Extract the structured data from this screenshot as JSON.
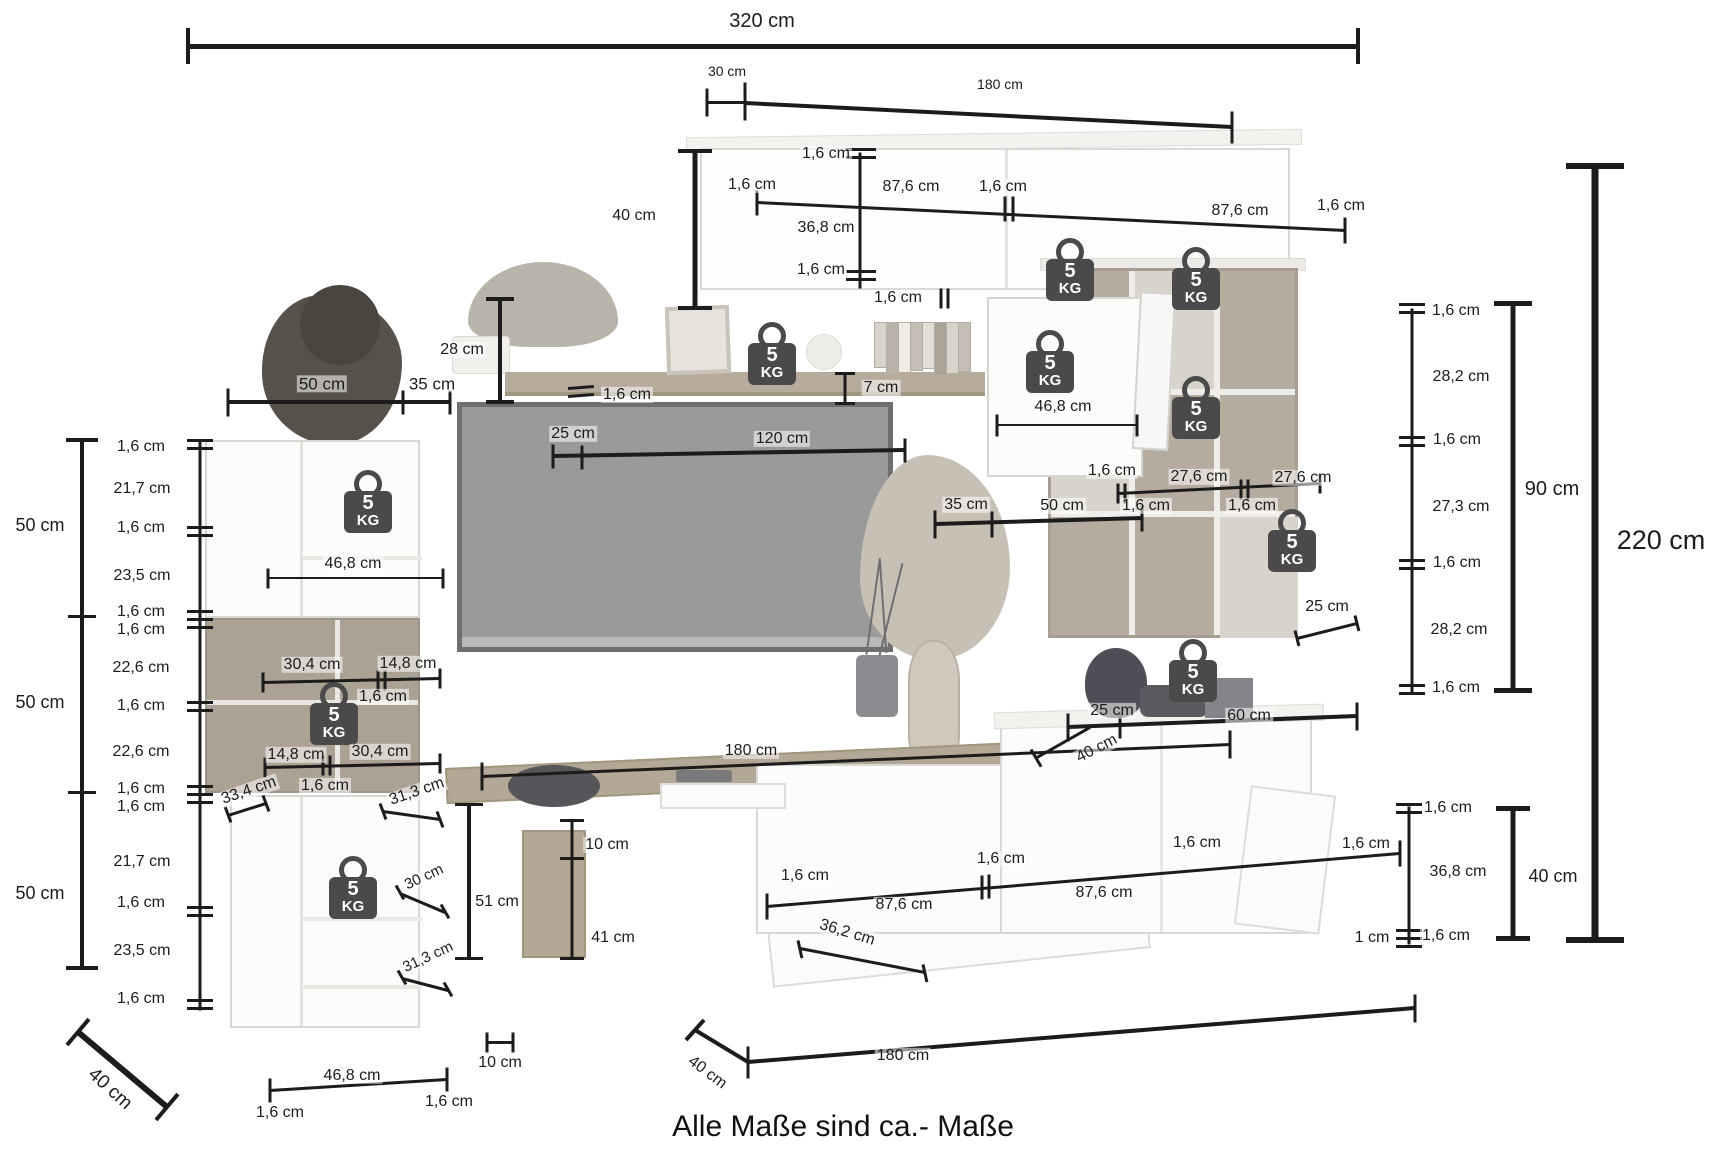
{
  "caption": "Alle Maße sind ca.- Maße",
  "unit": "cm",
  "weight_badge": {
    "value": "5",
    "unit": "KG"
  },
  "colors": {
    "line": "#1c1c1c",
    "label": "#1c1c1c",
    "badge": "#4a4a4a",
    "badge_text": "#ffffff",
    "wood": "#b3a795",
    "wood_dark": "#aca293",
    "white_furniture": "#fcfcfb",
    "tv_screen": "#9a9a9a"
  },
  "labels": [
    {
      "t": "320 cm",
      "x": 762,
      "y": 21,
      "fs": 20
    },
    {
      "t": "30 cm",
      "x": 727,
      "y": 71,
      "fs": 14
    },
    {
      "t": "180 cm",
      "x": 1000,
      "y": 84,
      "fs": 14
    },
    {
      "t": "40 cm",
      "x": 634,
      "y": 216
    },
    {
      "t": "1,6 cm",
      "x": 826,
      "y": 154
    },
    {
      "t": "1,6 cm",
      "x": 752,
      "y": 185
    },
    {
      "t": "87,6 cm",
      "x": 911,
      "y": 187
    },
    {
      "t": "1,6 cm",
      "x": 1003,
      "y": 187
    },
    {
      "t": "87,6 cm",
      "x": 1240,
      "y": 211
    },
    {
      "t": "1,6 cm",
      "x": 1341,
      "y": 206
    },
    {
      "t": "36,8 cm",
      "x": 826,
      "y": 228
    },
    {
      "t": "1,6 cm",
      "x": 821,
      "y": 270
    },
    {
      "t": "28 cm",
      "x": 462,
      "y": 350
    },
    {
      "t": "1,6 cm",
      "x": 627,
      "y": 395
    },
    {
      "t": "7 cm",
      "x": 881,
      "y": 388
    },
    {
      "t": "1,6 cm",
      "x": 898,
      "y": 298
    },
    {
      "t": "46,8 cm",
      "x": 1063,
      "y": 407
    },
    {
      "t": "25 cm",
      "x": 573,
      "y": 434
    },
    {
      "t": "120 cm",
      "x": 782,
      "y": 439
    },
    {
      "t": "1,6 cm",
      "x": 1112,
      "y": 471
    },
    {
      "t": "27,6 cm",
      "x": 1199,
      "y": 477
    },
    {
      "t": "27,6 cm",
      "x": 1303,
      "y": 478
    },
    {
      "t": "1,6 cm",
      "x": 1146,
      "y": 506
    },
    {
      "t": "1,6 cm",
      "x": 1252,
      "y": 506
    },
    {
      "t": "35 cm",
      "x": 966,
      "y": 505
    },
    {
      "t": "50 cm",
      "x": 1062,
      "y": 506
    },
    {
      "t": "1,6 cm",
      "x": 1456,
      "y": 311
    },
    {
      "t": "28,2 cm",
      "x": 1461,
      "y": 377
    },
    {
      "t": "1,6 cm",
      "x": 1457,
      "y": 440
    },
    {
      "t": "27,3 cm",
      "x": 1461,
      "y": 507
    },
    {
      "t": "1,6 cm",
      "x": 1457,
      "y": 563
    },
    {
      "t": "28,2 cm",
      "x": 1459,
      "y": 630
    },
    {
      "t": "1,6 cm",
      "x": 1456,
      "y": 688
    },
    {
      "t": "90 cm",
      "x": 1552,
      "y": 489,
      "fs": 20
    },
    {
      "t": "220 cm",
      "x": 1661,
      "y": 541,
      "fs": 27
    },
    {
      "t": "25 cm",
      "x": 1327,
      "y": 607
    },
    {
      "t": "25 cm",
      "x": 1112,
      "y": 711
    },
    {
      "t": "60 cm",
      "x": 1249,
      "y": 716
    },
    {
      "t": "40 cm",
      "x": 1097,
      "y": 749,
      "rot": -27
    },
    {
      "t": "180 cm",
      "x": 751,
      "y": 751
    },
    {
      "t": "10 cm",
      "x": 607,
      "y": 845
    },
    {
      "t": "51 cm",
      "x": 497,
      "y": 902
    },
    {
      "t": "41 cm",
      "x": 613,
      "y": 938
    },
    {
      "t": "1,6 cm",
      "x": 805,
      "y": 876
    },
    {
      "t": "87,6 cm",
      "x": 904,
      "y": 905
    },
    {
      "t": "1,6 cm",
      "x": 1001,
      "y": 859
    },
    {
      "t": "87,6 cm",
      "x": 1104,
      "y": 893
    },
    {
      "t": "1,6 cm",
      "x": 1197,
      "y": 843
    },
    {
      "t": "36,2 cm",
      "x": 847,
      "y": 933,
      "rot": 17
    },
    {
      "t": "1 cm",
      "x": 1372,
      "y": 938
    },
    {
      "t": "1,6 cm",
      "x": 1446,
      "y": 936
    },
    {
      "t": "1,6 cm",
      "x": 1448,
      "y": 808
    },
    {
      "t": "1,6 cm",
      "x": 1366,
      "y": 844
    },
    {
      "t": "36,8 cm",
      "x": 1458,
      "y": 872
    },
    {
      "t": "40 cm",
      "x": 1553,
      "y": 876,
      "fs": 18
    },
    {
      "t": "50  cm",
      "x": 322,
      "y": 384,
      "fs": 17
    },
    {
      "t": "35  cm",
      "x": 432,
      "y": 384,
      "fs": 17
    },
    {
      "t": "1,6 cm",
      "x": 141,
      "y": 447
    },
    {
      "t": "21,7 cm",
      "x": 142,
      "y": 489
    },
    {
      "t": "50 cm",
      "x": 40,
      "y": 525,
      "fs": 18
    },
    {
      "t": "1,6 cm",
      "x": 141,
      "y": 528
    },
    {
      "t": "23,5 cm",
      "x": 142,
      "y": 576
    },
    {
      "t": "1,6 cm",
      "x": 141,
      "y": 612
    },
    {
      "t": "1,6 cm",
      "x": 141,
      "y": 630
    },
    {
      "t": "22,6 cm",
      "x": 141,
      "y": 668
    },
    {
      "t": "50 cm",
      "x": 40,
      "y": 702,
      "fs": 18
    },
    {
      "t": "1,6 cm",
      "x": 141,
      "y": 706
    },
    {
      "t": "22,6 cm",
      "x": 141,
      "y": 752
    },
    {
      "t": "1,6 cm",
      "x": 141,
      "y": 789
    },
    {
      "t": "1,6 cm",
      "x": 141,
      "y": 807
    },
    {
      "t": "21,7 cm",
      "x": 142,
      "y": 862
    },
    {
      "t": "50 cm",
      "x": 40,
      "y": 893,
      "fs": 18
    },
    {
      "t": "1,6 cm",
      "x": 141,
      "y": 903
    },
    {
      "t": "23,5 cm",
      "x": 142,
      "y": 951
    },
    {
      "t": "1,6 cm",
      "x": 141,
      "y": 999
    },
    {
      "t": "46,8 cm",
      "x": 353,
      "y": 564
    },
    {
      "t": "30,4 cm",
      "x": 312,
      "y": 665
    },
    {
      "t": "14,8 cm",
      "x": 408,
      "y": 664
    },
    {
      "t": "1,6 cm",
      "x": 383,
      "y": 697
    },
    {
      "t": "14,8 cm",
      "x": 296,
      "y": 755
    },
    {
      "t": "30,4 cm",
      "x": 380,
      "y": 752
    },
    {
      "t": "1,6 cm",
      "x": 325,
      "y": 786
    },
    {
      "t": "33,4 cm",
      "x": 249,
      "y": 791,
      "rot": -19
    },
    {
      "t": "31,3 cm",
      "x": 417,
      "y": 792,
      "rot": -19
    },
    {
      "t": "30 cm",
      "x": 424,
      "y": 877,
      "fs": 15,
      "rot": -25
    },
    {
      "t": "31,3 cm",
      "x": 428,
      "y": 957,
      "fs": 15,
      "rot": -25
    },
    {
      "t": "46,8 cm",
      "x": 352,
      "y": 1076
    },
    {
      "t": "1,6 cm",
      "x": 280,
      "y": 1113
    },
    {
      "t": "1,6 cm",
      "x": 449,
      "y": 1102
    },
    {
      "t": "40 cm",
      "x": 110,
      "y": 1089,
      "fs": 19,
      "rot": 42
    },
    {
      "t": "10 cm",
      "x": 500,
      "y": 1063
    },
    {
      "t": "40 cm",
      "x": 707,
      "y": 1073,
      "rot": 37
    },
    {
      "t": "180 cm",
      "x": 903,
      "y": 1056
    }
  ],
  "weights": [
    {
      "x": 1070,
      "y": 268
    },
    {
      "x": 772,
      "y": 352
    },
    {
      "x": 1050,
      "y": 360
    },
    {
      "x": 1196,
      "y": 277
    },
    {
      "x": 1196,
      "y": 406
    },
    {
      "x": 1292,
      "y": 539
    },
    {
      "x": 1193,
      "y": 669
    },
    {
      "x": 368,
      "y": 500
    },
    {
      "x": 334,
      "y": 712
    },
    {
      "x": 353,
      "y": 886
    }
  ],
  "lines": [
    [
      190,
      46,
      1360,
      46,
      5
    ],
    [
      188,
      28,
      188,
      64,
      4
    ],
    [
      1358,
      28,
      1358,
      64,
      4
    ],
    [
      707,
      88,
      707,
      116,
      3
    ],
    [
      745,
      82,
      745,
      120,
      3
    ],
    [
      707,
      102,
      745,
      102,
      3
    ],
    [
      745,
      103,
      1232,
      127,
      4
    ],
    [
      1232,
      111,
      1232,
      143,
      3
    ],
    [
      695,
      152,
      695,
      308,
      5
    ],
    [
      678,
      151,
      712,
      151,
      4
    ],
    [
      678,
      308,
      712,
      308,
      4
    ],
    [
      860,
      152,
      860,
      288,
      3
    ],
    [
      846,
      149,
      876,
      149,
      3
    ],
    [
      846,
      157,
      876,
      157,
      3
    ],
    [
      846,
      271,
      876,
      271,
      3
    ],
    [
      846,
      279,
      876,
      279,
      3
    ],
    [
      757,
      202,
      1345,
      230,
      3
    ],
    [
      757,
      190,
      757,
      215,
      3
    ],
    [
      1005,
      196,
      1005,
      221,
      3
    ],
    [
      1013,
      196,
      1013,
      221,
      3
    ],
    [
      1345,
      217,
      1345,
      243,
      3
    ],
    [
      500,
      300,
      500,
      402,
      4
    ],
    [
      486,
      299,
      514,
      299,
      4
    ],
    [
      486,
      402,
      514,
      402,
      4
    ],
    [
      568,
      388,
      594,
      386,
      3
    ],
    [
      568,
      396,
      594,
      394,
      3
    ],
    [
      845,
      374,
      845,
      403,
      3
    ],
    [
      835,
      373,
      855,
      373,
      3
    ],
    [
      835,
      403,
      855,
      403,
      3
    ],
    [
      941,
      288,
      941,
      308,
      3
    ],
    [
      948,
      288,
      948,
      308,
      3
    ],
    [
      997,
      425,
      1137,
      425,
      2
    ],
    [
      997,
      414,
      997,
      436,
      3
    ],
    [
      1137,
      414,
      1137,
      436,
      3
    ],
    [
      553,
      456,
      905,
      450,
      4
    ],
    [
      553,
      444,
      553,
      468,
      3
    ],
    [
      582,
      445,
      582,
      469,
      3
    ],
    [
      905,
      438,
      905,
      462,
      3
    ],
    [
      1118,
      493,
      1320,
      483,
      3
    ],
    [
      1118,
      483,
      1118,
      503,
      3
    ],
    [
      1125,
      483,
      1125,
      503,
      3
    ],
    [
      1241,
      479,
      1241,
      499,
      3
    ],
    [
      1248,
      479,
      1248,
      499,
      3
    ],
    [
      1320,
      473,
      1320,
      493,
      3
    ],
    [
      935,
      524,
      1142,
      518,
      4
    ],
    [
      935,
      510,
      935,
      538,
      3
    ],
    [
      992,
      511,
      992,
      537,
      3
    ],
    [
      1142,
      505,
      1142,
      531,
      3
    ],
    [
      1297,
      638,
      1357,
      623,
      3
    ],
    [
      1295,
      630,
      1299,
      646,
      3
    ],
    [
      1355,
      615,
      1359,
      631,
      3
    ],
    [
      1412,
      308,
      1412,
      692,
      3
    ],
    [
      1399,
      304,
      1425,
      304,
      3
    ],
    [
      1399,
      312,
      1425,
      312,
      3
    ],
    [
      1399,
      437,
      1425,
      437,
      3
    ],
    [
      1399,
      445,
      1425,
      445,
      3
    ],
    [
      1399,
      560,
      1425,
      560,
      3
    ],
    [
      1399,
      568,
      1425,
      568,
      3
    ],
    [
      1399,
      685,
      1425,
      685,
      3
    ],
    [
      1399,
      693,
      1425,
      693,
      3
    ],
    [
      1513,
      305,
      1513,
      690,
      5
    ],
    [
      1494,
      303,
      1532,
      303,
      5
    ],
    [
      1494,
      690,
      1532,
      690,
      5
    ],
    [
      1595,
      168,
      1595,
      940,
      7
    ],
    [
      1566,
      166,
      1624,
      166,
      6
    ],
    [
      1566,
      940,
      1624,
      940,
      6
    ],
    [
      1068,
      727,
      1357,
      716,
      4
    ],
    [
      1068,
      713,
      1068,
      741,
      3
    ],
    [
      1120,
      712,
      1120,
      738,
      3
    ],
    [
      1357,
      702,
      1357,
      730,
      3
    ],
    [
      1037,
      757,
      1090,
      727,
      3
    ],
    [
      1031,
      749,
      1041,
      766,
      3
    ],
    [
      82,
      440,
      82,
      968,
      4
    ],
    [
      66,
      440,
      98,
      440,
      4
    ],
    [
      68,
      616,
      96,
      616,
      3
    ],
    [
      68,
      792,
      96,
      792,
      3
    ],
    [
      66,
      968,
      98,
      968,
      4
    ],
    [
      200,
      440,
      200,
      1010,
      3
    ],
    [
      187,
      440,
      213,
      440,
      3
    ],
    [
      187,
      448,
      213,
      448,
      3
    ],
    [
      187,
      527,
      213,
      527,
      3
    ],
    [
      187,
      535,
      213,
      535,
      3
    ],
    [
      187,
      611,
      213,
      611,
      3
    ],
    [
      187,
      619,
      213,
      619,
      3
    ],
    [
      187,
      627,
      213,
      627,
      3
    ],
    [
      187,
      702,
      213,
      702,
      3
    ],
    [
      187,
      710,
      213,
      710,
      3
    ],
    [
      187,
      786,
      213,
      786,
      3
    ],
    [
      187,
      794,
      213,
      794,
      3
    ],
    [
      187,
      802,
      213,
      802,
      3
    ],
    [
      187,
      907,
      213,
      907,
      3
    ],
    [
      187,
      915,
      213,
      915,
      3
    ],
    [
      187,
      1000,
      213,
      1000,
      3
    ],
    [
      187,
      1008,
      213,
      1008,
      3
    ],
    [
      228,
      402,
      450,
      402,
      4
    ],
    [
      228,
      388,
      228,
      416,
      3
    ],
    [
      403,
      390,
      403,
      414,
      3
    ],
    [
      450,
      390,
      450,
      414,
      3
    ],
    [
      268,
      578,
      443,
      578,
      2
    ],
    [
      268,
      568,
      268,
      588,
      3
    ],
    [
      443,
      568,
      443,
      588,
      3
    ],
    [
      263,
      682,
      440,
      678,
      3
    ],
    [
      263,
      672,
      263,
      692,
      3
    ],
    [
      378,
      670,
      378,
      690,
      3
    ],
    [
      385,
      670,
      385,
      690,
      3
    ],
    [
      440,
      668,
      440,
      688,
      3
    ],
    [
      265,
      767,
      440,
      763,
      3
    ],
    [
      265,
      757,
      265,
      777,
      3
    ],
    [
      323,
      755,
      323,
      775,
      3
    ],
    [
      330,
      755,
      330,
      775,
      3
    ],
    [
      440,
      753,
      440,
      773,
      3
    ],
    [
      228,
      815,
      266,
      803,
      3
    ],
    [
      225,
      806,
      231,
      822,
      3
    ],
    [
      263,
      795,
      269,
      811,
      3
    ],
    [
      383,
      811,
      440,
      819,
      3
    ],
    [
      380,
      803,
      386,
      819,
      3
    ],
    [
      437,
      811,
      443,
      827,
      3
    ],
    [
      400,
      893,
      445,
      912,
      3
    ],
    [
      396,
      885,
      404,
      899,
      3
    ],
    [
      441,
      904,
      449,
      918,
      3
    ],
    [
      402,
      978,
      448,
      990,
      3
    ],
    [
      398,
      970,
      406,
      984,
      3
    ],
    [
      444,
      982,
      452,
      996,
      3
    ],
    [
      270,
      1090,
      447,
      1079,
      3
    ],
    [
      270,
      1078,
      270,
      1102,
      3
    ],
    [
      447,
      1067,
      447,
      1091,
      3
    ],
    [
      78,
      1032,
      167,
      1107,
      6
    ],
    [
      67,
      1045,
      89,
      1019,
      4
    ],
    [
      156,
      1120,
      178,
      1094,
      4
    ],
    [
      469,
      805,
      469,
      958,
      4
    ],
    [
      455,
      804,
      483,
      804,
      3
    ],
    [
      455,
      958,
      483,
      958,
      3
    ],
    [
      572,
      820,
      572,
      958,
      3
    ],
    [
      560,
      820,
      584,
      820,
      3
    ],
    [
      560,
      858,
      584,
      858,
      3
    ],
    [
      560,
      958,
      584,
      958,
      3
    ],
    [
      482,
      776,
      1230,
      744,
      3
    ],
    [
      482,
      762,
      482,
      790,
      3
    ],
    [
      1230,
      730,
      1230,
      758,
      3
    ],
    [
      767,
      906,
      1400,
      853,
      3
    ],
    [
      767,
      893,
      767,
      919,
      3
    ],
    [
      982,
      875,
      982,
      899,
      3
    ],
    [
      989,
      874,
      989,
      898,
      3
    ],
    [
      1400,
      840,
      1400,
      866,
      3
    ],
    [
      800,
      948,
      925,
      972,
      3
    ],
    [
      798,
      940,
      802,
      958,
      3
    ],
    [
      923,
      964,
      927,
      982,
      3
    ],
    [
      1409,
      806,
      1409,
      944,
      3
    ],
    [
      1396,
      804,
      1422,
      804,
      3
    ],
    [
      1396,
      812,
      1422,
      812,
      3
    ],
    [
      1396,
      930,
      1422,
      930,
      3
    ],
    [
      1396,
      938,
      1422,
      938,
      3
    ],
    [
      1396,
      946,
      1422,
      946,
      3
    ],
    [
      1513,
      810,
      1513,
      938,
      5
    ],
    [
      1496,
      808,
      1530,
      808,
      5
    ],
    [
      1496,
      938,
      1530,
      938,
      5
    ],
    [
      487,
      1042,
      513,
      1042,
      3
    ],
    [
      487,
      1032,
      487,
      1052,
      3
    ],
    [
      513,
      1032,
      513,
      1052,
      3
    ],
    [
      695,
      1030,
      748,
      1062,
      4
    ],
    [
      686,
      1040,
      704,
      1020,
      4
    ],
    [
      748,
      1046,
      748,
      1078,
      3
    ],
    [
      748,
      1062,
      1415,
      1008,
      4
    ],
    [
      1415,
      994,
      1415,
      1022,
      3
    ]
  ]
}
